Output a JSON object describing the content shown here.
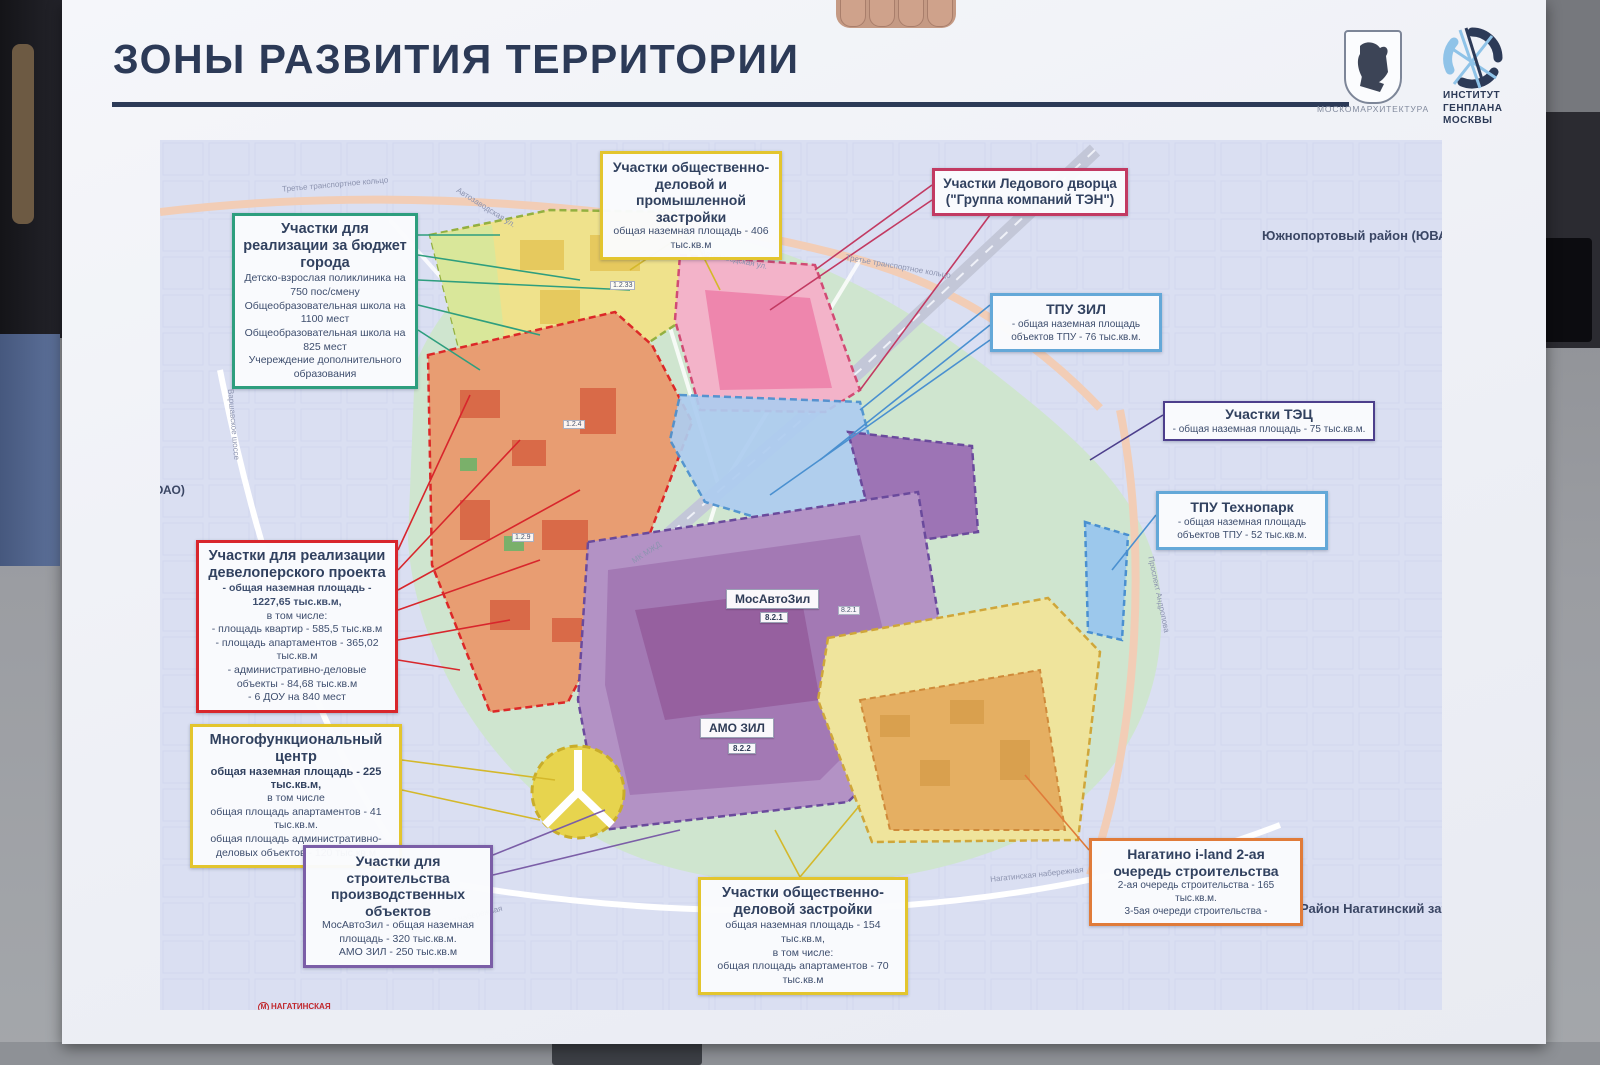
{
  "poster": {
    "title": "ЗОНЫ РАЗВИТИЯ ТЕРРИТОРИИ",
    "logo_moskom": "МОСКОМАРХИТЕКТУРА",
    "logo_genplan": "ИНСТИТУТ\nГЕНПЛАНА\nМОСКВЫ"
  },
  "map": {
    "region_labels": [
      "Южнопортовый район (ЮВАО",
      "Район Нагатинский затон",
      "ОАО)"
    ],
    "streets": [
      "Третье транспортное кольцо",
      "Автозаводская ул.",
      "Проспект Андропова",
      "Нагатинская набережная",
      "Варшавское шоссе",
      "МК МЖД"
    ],
    "metro": "НАГАТИНСКАЯ",
    "zone_chips": [
      {
        "name": "МосАвтоЗил",
        "code": "8.2.1"
      },
      {
        "name": "АМО ЗИЛ",
        "code": "8.2.2"
      }
    ],
    "small_chips": [
      "1.2.33",
      "1.2.4",
      "1.2.9",
      "8.2.1"
    ]
  },
  "callouts": {
    "budget": {
      "title": "Участки для реализации за бюджет города",
      "lines": [
        "Детско-взрослая поликлиника на 750 пос/смену",
        "Общеобразовательная школа на 1100 мест",
        "Общеобразовательная школа на 825 мест",
        "Учереждение дополнительного образования"
      ]
    },
    "industrial": {
      "title": "Участки общественно-деловой и промышленной застройки",
      "lines": [
        "общая наземная площадь - 406 тыс.кв.м"
      ]
    },
    "ice": {
      "title": "Участки Ледового дворца",
      "title2": "(\"Группа компаний ТЭН\")"
    },
    "tpu_zil": {
      "title": "ТПУ ЗИЛ",
      "lines": [
        "- общая наземная площадь объектов ТПУ - 76 тыс.кв.м."
      ]
    },
    "tec": {
      "title": "Участки ТЭЦ",
      "lines": [
        "- общая наземная площадь - 75 тыс.кв.м."
      ]
    },
    "technopark": {
      "title": "ТПУ Технопарк",
      "lines": [
        "- общая наземная площадь объектов ТПУ - 52 тыс.кв.м."
      ]
    },
    "developer": {
      "title": "Участки для реализации девелоперского проекта",
      "lines": [
        "- общая наземная площадь - 1227,65 тыс.кв.м,",
        "в том числе:",
        "- площадь квартир - 585,5 тыс.кв.м",
        "- площадь апартаментов - 365,02 тыс.кв.м",
        "- административно-деловые объекты - 84,68 тыс.кв.м",
        "- 6 ДОУ на 840 мест"
      ]
    },
    "multifunc": {
      "title": "Многофункциональный центр",
      "subtitle": "общая наземная площадь - 225 тыс.кв.м,",
      "lines": [
        "в том числе",
        "общая площадь апартаментов - 41 тыс.кв.м.",
        "общая площадь административно-деловых объектов - 120 тыс.кв.м"
      ]
    },
    "production": {
      "title": "Участки для строительства производственных объектов",
      "lines": [
        "МосАвтоЗил - общая наземная площадь - 320 тыс.кв.м.",
        "АМО ЗИЛ - 250 тыс.кв.м"
      ]
    },
    "business": {
      "title": "Участки общественно-деловой застройки",
      "lines": [
        "общая наземная площадь - 154 тыс.кв.м,",
        "в том числе:",
        "общая площадь апартаментов - 70 тыс.кв.м"
      ]
    },
    "nagatino": {
      "title": "Нагатино i-land 2-ая очередь строительства",
      "lines": [
        "2-ая очередь строительства - 165 тыс.кв.м.",
        "3-5ая очереди строительства -"
      ]
    }
  },
  "colors": {
    "title_navy": "#2c3a57",
    "border_green": "#2e9e7e",
    "border_yellow": "#e3c52e",
    "border_crimson": "#c23a62",
    "border_blue": "#64a8d8",
    "border_violet": "#4d3f8c",
    "border_red": "#d8262c",
    "border_purple": "#7b5ea7",
    "border_orange": "#e07b39",
    "metro_red": "#c0272d"
  }
}
